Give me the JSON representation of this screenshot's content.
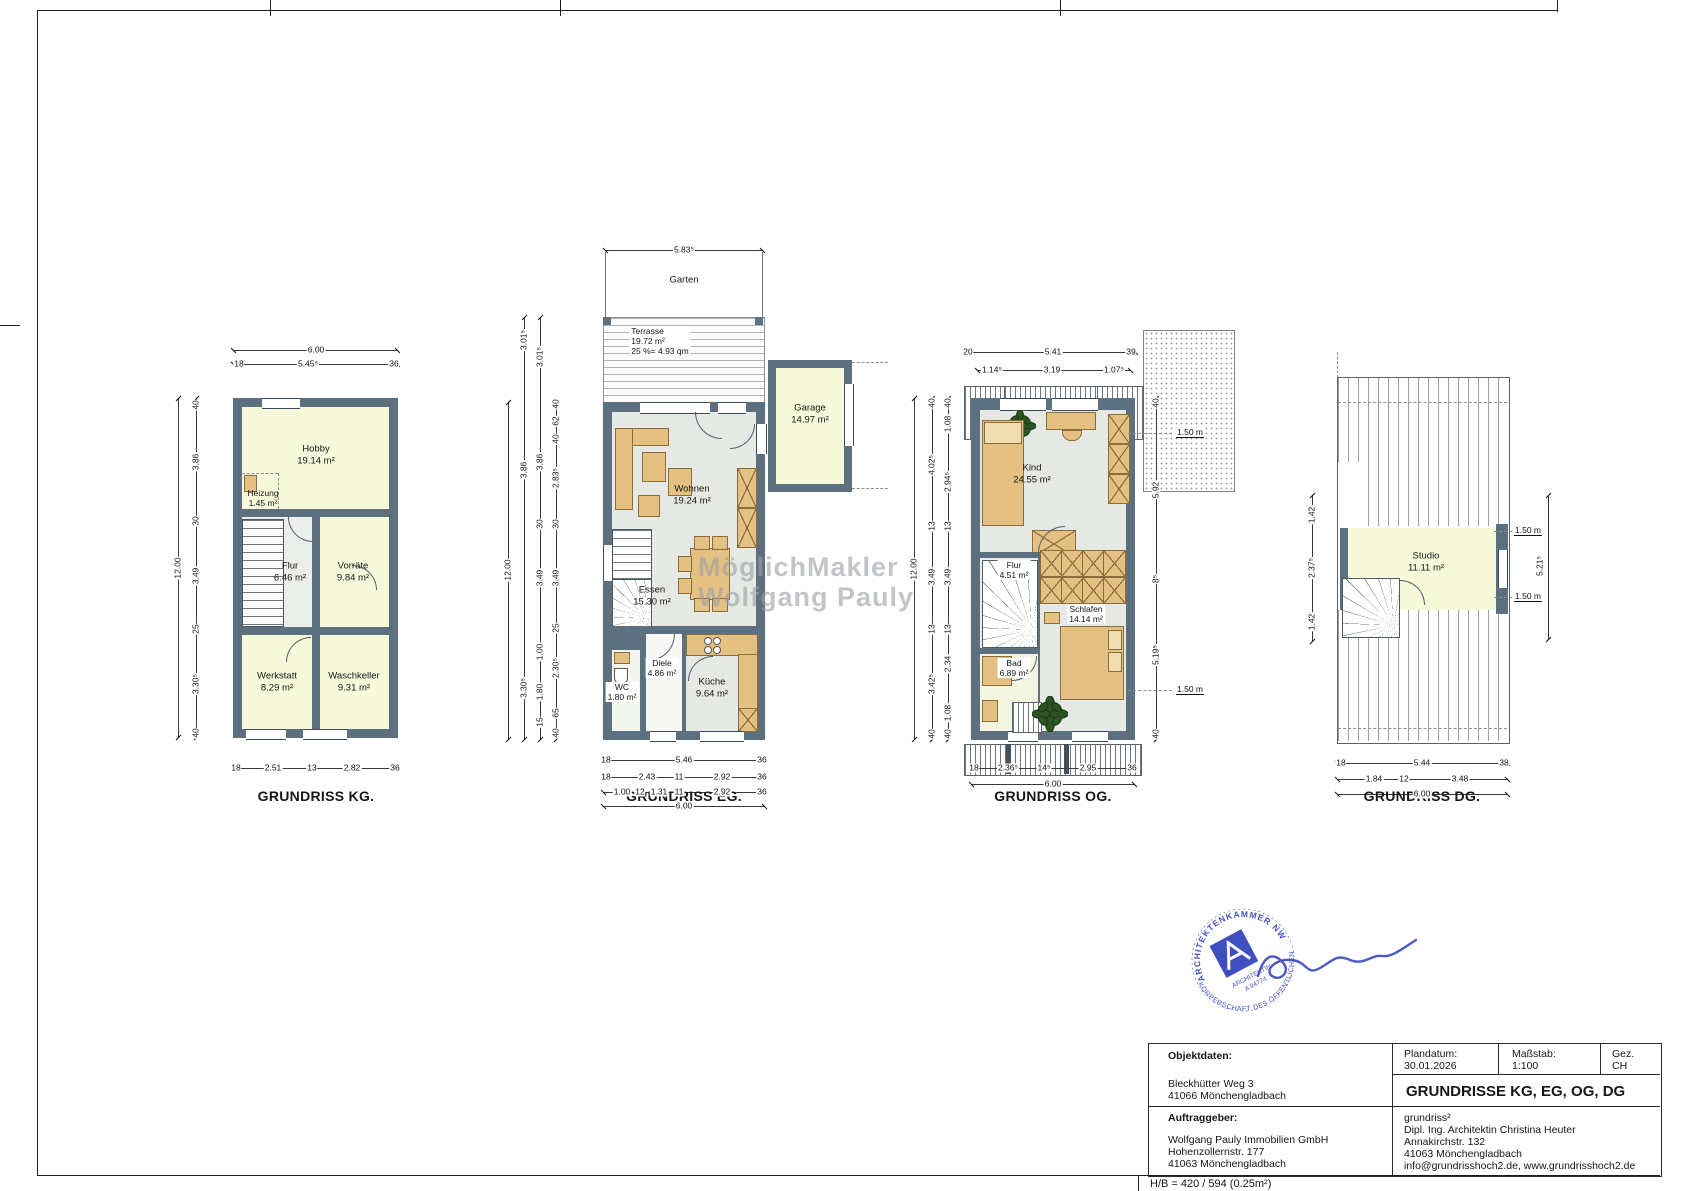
{
  "sheet": {
    "hb_note": "H/B = 420 / 594 (0.25m²)"
  },
  "watermark": {
    "line1": "MöglichMakler",
    "line2": "Wolfgang Pauly"
  },
  "stamp": {
    "arc_top": "ARCHITEKTENKAMMER NW",
    "arc_bottom": "KÖRPERSCHAFT DES ÖFFENTLICHEN",
    "line1": "ARCHITEKTIN",
    "line2": "A 94774"
  },
  "plans": {
    "kg": {
      "caption": "GRUNDRISS KG.",
      "rooms": {
        "hobby": {
          "name": "Hobby",
          "area": "19.14 m²"
        },
        "heizung": {
          "name": "Heizung",
          "area": "1.45 m²",
          "tag": "H2"
        },
        "flur": {
          "name": "Flur",
          "area": "6.46 m²"
        },
        "vorraete": {
          "name": "Vorräte",
          "area": "9.84 m²"
        },
        "werkstatt": {
          "name": "Werkstatt",
          "area": "8.29 m²"
        },
        "waschkeller": {
          "name": "Waschkeller",
          "area": "9.31 m²"
        }
      },
      "dims": {
        "top_total": "6.00",
        "top_row": [
          "18",
          "5.45⁵",
          "36"
        ],
        "left_chain": [
          "40",
          "3.86",
          "30",
          "3.49",
          "25",
          "3.30⁵",
          "40"
        ],
        "left_total": "12.00",
        "bottom_row": [
          "18",
          "2.51",
          "13",
          "2.82",
          "36"
        ]
      }
    },
    "eg": {
      "caption": "GRUNDRISS EG.",
      "rooms": {
        "garten": {
          "name": "Garten"
        },
        "terrasse": {
          "name": "Terrasse",
          "area": "19.72 m²",
          "note": "25 %= 4.93 qm"
        },
        "garage": {
          "name": "Garage",
          "area": "14.97 m²"
        },
        "wohnen": {
          "name": "Wohnen",
          "area": "19.24 m²"
        },
        "essen": {
          "name": "Essen",
          "area": "15.30 m²"
        },
        "diele": {
          "name": "Diele",
          "area": "4.86 m²"
        },
        "wc": {
          "name": "WC",
          "area": "1.80 m²"
        },
        "kueche": {
          "name": "Küche",
          "area": "9.64 m²"
        }
      },
      "dims": {
        "top_total": "5.83⁵",
        "left_chain1": [
          "40",
          "62",
          "40",
          "2.83⁵",
          "30",
          "3.49",
          "25",
          "2.30⁵",
          "65",
          "40"
        ],
        "left_chain2": [
          "3.01⁵",
          "3.86",
          "30",
          "3.49",
          "1.00",
          "1.80",
          "15"
        ],
        "left_chain3": [
          "3.01⁵",
          "3.86",
          "3.30⁵"
        ],
        "left_total": "12.00",
        "bottom_row1": [
          "18",
          "5.46",
          "36"
        ],
        "bottom_row2": [
          "18",
          "2.43",
          "11",
          "2.92",
          "36"
        ],
        "bottom_row3": [
          "1.00",
          "12",
          "1.31",
          "11",
          "2.92",
          "36"
        ],
        "bottom_total": "6.00"
      }
    },
    "og": {
      "caption": "GRUNDRISS OG.",
      "rooms": {
        "kind": {
          "name": "Kind",
          "area": "24.55 m²"
        },
        "flur": {
          "name": "Flur",
          "area": "4.51 m²"
        },
        "schlafen": {
          "name": "Schlafen",
          "area": "14.14 m²"
        },
        "bad": {
          "name": "Bad",
          "area": "6.89 m²"
        }
      },
      "labels": {
        "h150_top": "1.50 m",
        "h150_bottom": "1.50 m"
      },
      "dims": {
        "top_row1": [
          "20",
          "5.41",
          "39"
        ],
        "top_row2": [
          "1.14⁵",
          "3.19",
          "1.07⁵"
        ],
        "left_chain1": [
          "40",
          "1.08",
          "2.94⁵",
          "13",
          "3.49",
          "13",
          "2.34",
          "1.08",
          "40"
        ],
        "left_chain2": [
          "40",
          "4.02⁵",
          "13",
          "3.49",
          "13",
          "3.42⁵",
          "40"
        ],
        "left_total": "12.00",
        "right_chain": [
          "40",
          "5.92",
          "8⁵",
          "5.19⁵",
          "40"
        ],
        "bottom_row": [
          "18",
          "2.36⁵",
          "14⁵",
          "2.95",
          "36"
        ],
        "bottom_total": "6.00"
      }
    },
    "dg": {
      "caption": "GRUNDRISS DG.",
      "rooms": {
        "studio": {
          "name": "Studio",
          "area": "11.11 m²"
        }
      },
      "labels": {
        "h150_top": "1.50 m",
        "h150_bottom": "1.50 m"
      },
      "dims": {
        "left_chain": [
          "1.42",
          "2.37⁵",
          "1.42"
        ],
        "right_total": "5.21⁵",
        "bottom_row1": [
          "18",
          "5.44",
          "38"
        ],
        "bottom_row2": [
          "1.84",
          "12",
          "3.48"
        ],
        "bottom_total": "6.00"
      }
    }
  },
  "title_block": {
    "objektdaten_label": "Objektdaten:",
    "objekt_line1": "Bleckhütter Weg 3",
    "objekt_line2": "41066 Mönchengladbach",
    "plandatum_label": "Plandatum:",
    "plandatum_value": "30.01.2026",
    "massstab_label": "Maßstab:",
    "massstab_value": "1:100",
    "gez_label": "Gez.",
    "gez_value": "CH",
    "title": "GRUNDRISSE KG, EG, OG, DG",
    "auftraggeber_label": "Auftraggeber:",
    "auftraggeber_line1": "Wolfgang Pauly Immobilien GmbH",
    "auftraggeber_line2": "Hohenzollernstr. 177",
    "auftraggeber_line3": "41063 Mönchengladbach",
    "architect_line1": "grundriss²",
    "architect_line2": "Dipl. Ing. Architektin Christina Heuter",
    "architect_line3": "Annakirchstr. 132",
    "architect_line4": "41063 Mönchengladbach",
    "architect_line5": "info@grundrisshoch2.de, www.grundrisshoch2.de"
  }
}
